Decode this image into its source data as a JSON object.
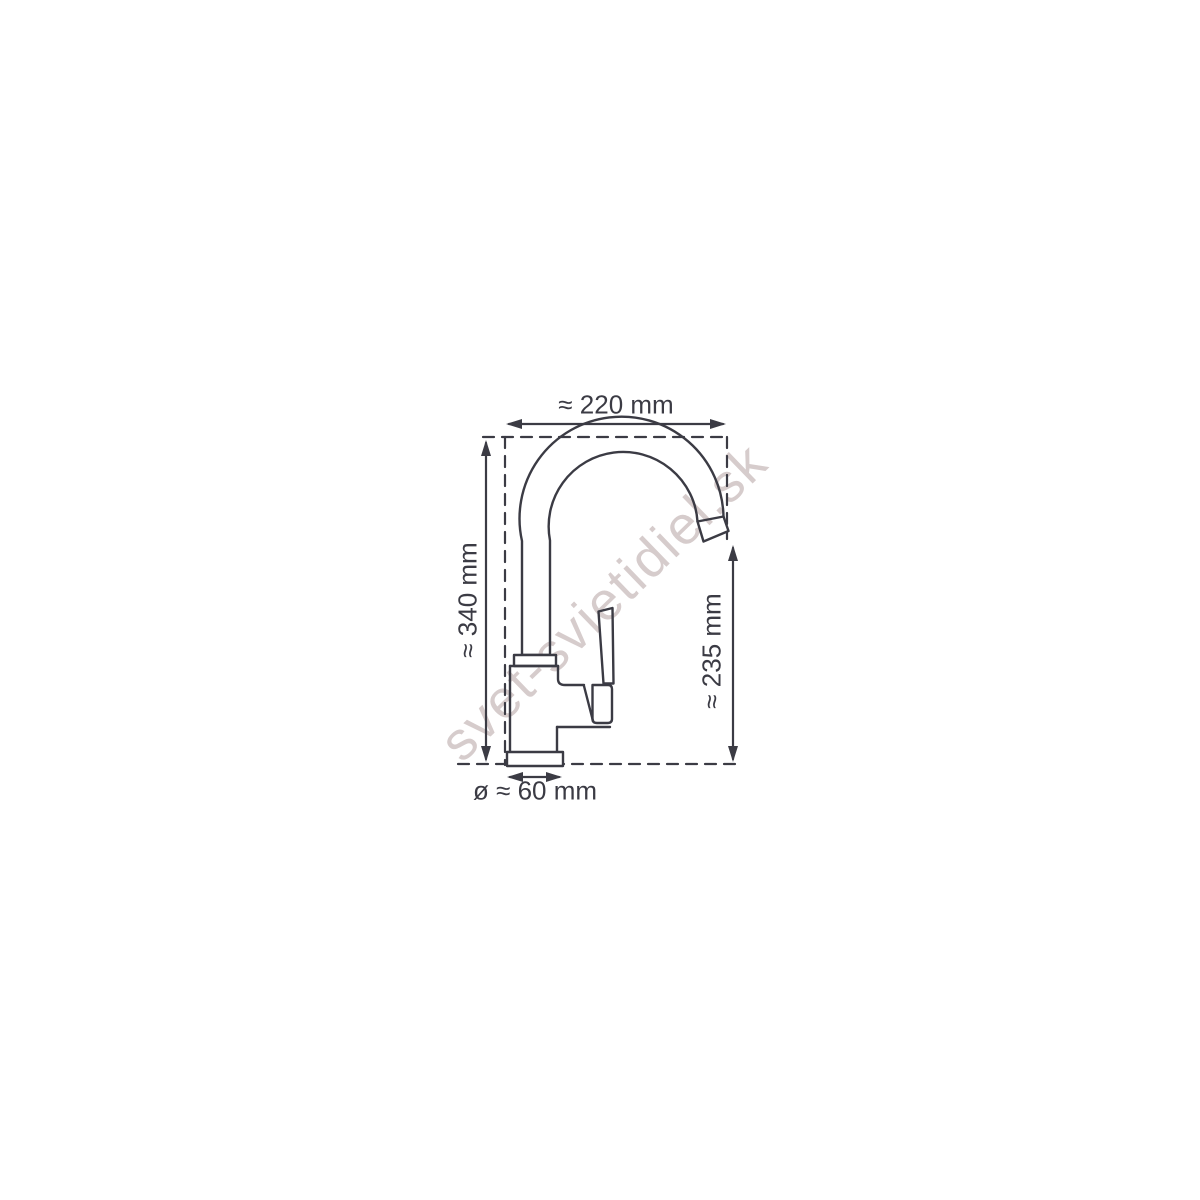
{
  "watermark": {
    "text": "svet-svietidiel.sk"
  },
  "dimensions": {
    "top": {
      "label": "≈ 220 mm",
      "meaning": "spout reach width"
    },
    "left": {
      "label": "≈ 340 mm",
      "meaning": "total height"
    },
    "right": {
      "label": "≈ 235 mm",
      "meaning": "spout outlet height"
    },
    "bottom": {
      "label": "ø ≈ 60 mm",
      "meaning": "base diameter"
    }
  },
  "colors": {
    "line": "#3b3b44",
    "watermark": "#d6cccc",
    "background": "#ffffff"
  }
}
